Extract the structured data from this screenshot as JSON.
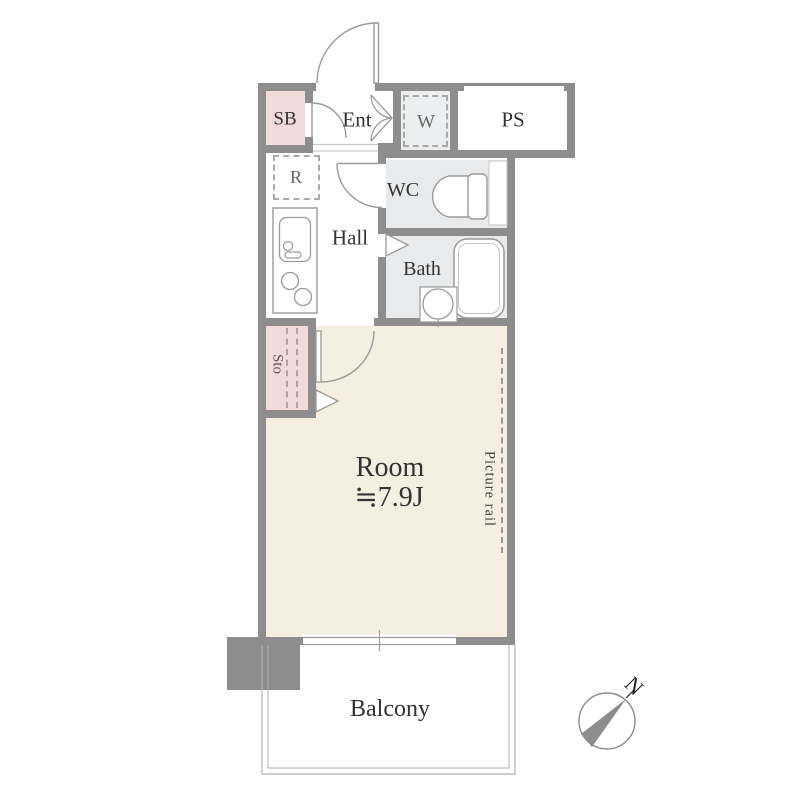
{
  "floor_plan": {
    "rooms": {
      "sb": "SB",
      "ent": "Ent",
      "w": "W",
      "ps": "PS",
      "r": "R",
      "hall": "Hall",
      "wc": "WC",
      "bath": "Bath",
      "sto": "Sto",
      "room": {
        "label": "Room",
        "size": "≒7.9J"
      },
      "balcony": "Balcony"
    },
    "annotations": {
      "picture_rail": "Picture rail",
      "compass_north": "N"
    },
    "colors": {
      "wall_gray": "#8d8d8d",
      "accent_pink": "#f1dbda",
      "room_cream": "#f5efe2",
      "wet_area_gray": "#e8eaeb",
      "closet_gray": "#eceeef"
    }
  }
}
